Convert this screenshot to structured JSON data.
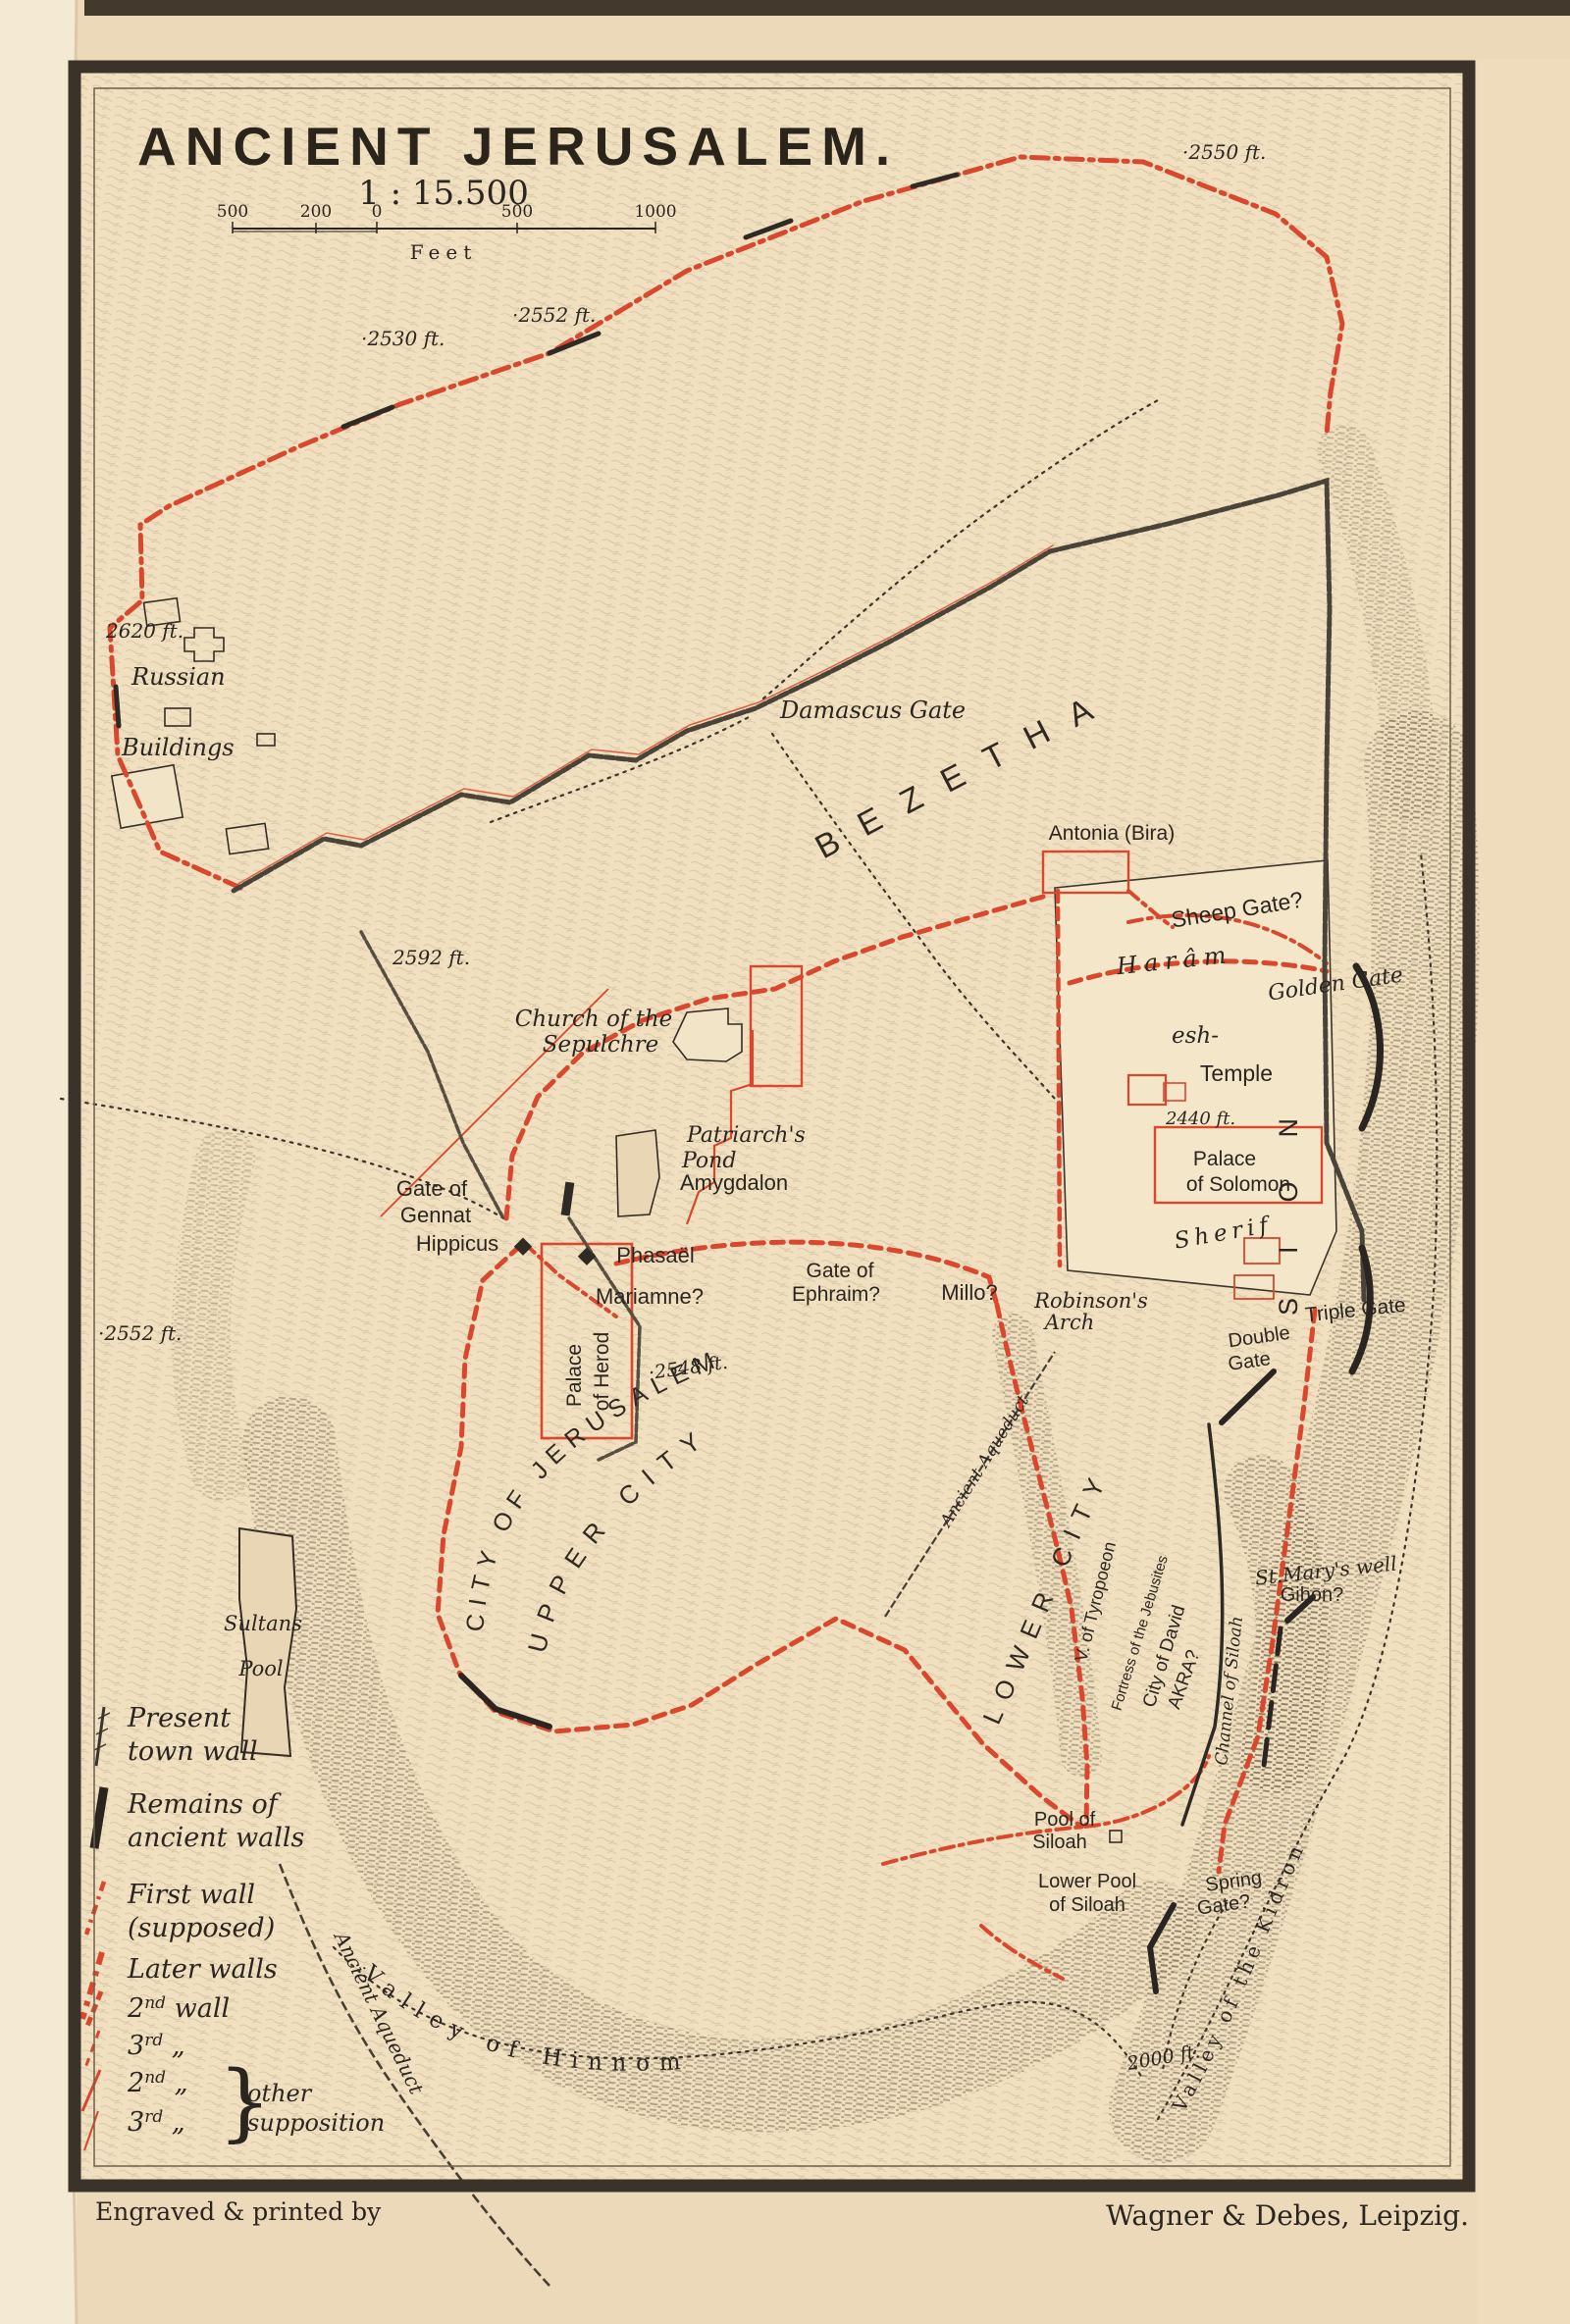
{
  "title": "ANCIENT JERUSALEM.",
  "scale": {
    "ratio": "1 : 15.500",
    "ticks": [
      "500",
      "200",
      "0",
      "500",
      "1000"
    ],
    "unit": "Feet"
  },
  "credits": {
    "engraver": "Engraved & printed by",
    "publisher": "Wagner & Debes, Leipzig."
  },
  "colors": {
    "paper": "#efe0c1",
    "ink": "#2b2520",
    "red": "#d8472e",
    "hatch": "#8e7c5e"
  },
  "legend": {
    "present_wall_1": "Present",
    "present_wall_2": "town wall",
    "remains_1": "Remains of",
    "remains_2": "ancient walls",
    "first_wall_1": "First wall",
    "first_wall_2": "(supposed)",
    "later_walls": "Later walls",
    "w2": {
      "num": "2",
      "sup": "nd",
      "rest": " wall"
    },
    "w3": {
      "num": "3",
      "sup": "rd",
      "rest": " „"
    },
    "w2b": {
      "num": "2",
      "sup": "nd",
      "rest": " „"
    },
    "w3b": {
      "num": "3",
      "sup": "rd",
      "rest": " „"
    },
    "brace": "}",
    "other_1": "other",
    "other_2": "supposition"
  },
  "labels": {
    "elev_2550": "·2550 ft.",
    "elev_2552_ne": "·2552 ft.",
    "elev_2530": "·2530 ft.",
    "elev_2620": "2620 ft.",
    "elev_2592": "2592 ft.",
    "elev_2552_w": "·2552 ft.",
    "elev_2548": "·2548 ft.",
    "elev_2440": "2440 ft.",
    "elev_2000": "2000 ft.",
    "russian_1": "Russian",
    "russian_2": "Buildings",
    "damascus_gate": "Damascus Gate",
    "bezetha": "BEZETHA",
    "church_1": "Church of the",
    "church_2": "Sepulchre",
    "antonia": "Antonia (Bira)",
    "sheep_gate": "Sheep Gate?",
    "haram": "Harâm",
    "esh": "esh-",
    "temple": "Temple",
    "sherif": "Sherif",
    "golden_gate": "Golden Gate",
    "palace_solomon_1": "Palace",
    "palace_solomon_2": "of Solomon",
    "sion": "SION",
    "patriarchs_1": "Patriarch's",
    "patriarchs_2": "Pond",
    "amygdalon": "Amygdalon",
    "gennat_1": "Gate of",
    "gennat_2": "Gennat",
    "hippicus": "Hippicus",
    "phasael": "Phasaël",
    "mariamne": "Mariamne?",
    "ephraim_1": "Gate of",
    "ephraim_2": "Ephraim?",
    "millo": "Millo?",
    "robinson_1": "Robinson's",
    "robinson_2": "Arch",
    "triple_gate": "Triple Gate",
    "double_1": "Double",
    "double_2": "Gate",
    "herod_1": "Palace",
    "herod_2": "of Herod",
    "city_jerusalem": "CITY OF JERUSALEM",
    "upper_city": "UPPER CITY",
    "lower_city": "LOWER CITY",
    "tyropoeon": "V. of Tyropoeon",
    "fortress": "Fortress of the Jebusites",
    "city_david": "City of David",
    "akra": "AKRA?",
    "channel": "Channel of Siloah",
    "st_marys": "St.Mary's well",
    "gihon": "Gihon?",
    "pool_siloah_1": "Pool of",
    "pool_siloah_2": "Siloah",
    "lower_pool_1": "Lower Pool",
    "lower_pool_2": "of Siloah",
    "spring_1": "Spring",
    "spring_2": "Gate?",
    "hinnom": "Valley of Hinnom",
    "kidron": "Valley of the Kidron",
    "aqueduct_w": "Ancient Aqueduct",
    "aqueduct_e": "Ancient Aqueduct",
    "sultans_1": "Sultans",
    "sultans_2": "Pool"
  }
}
